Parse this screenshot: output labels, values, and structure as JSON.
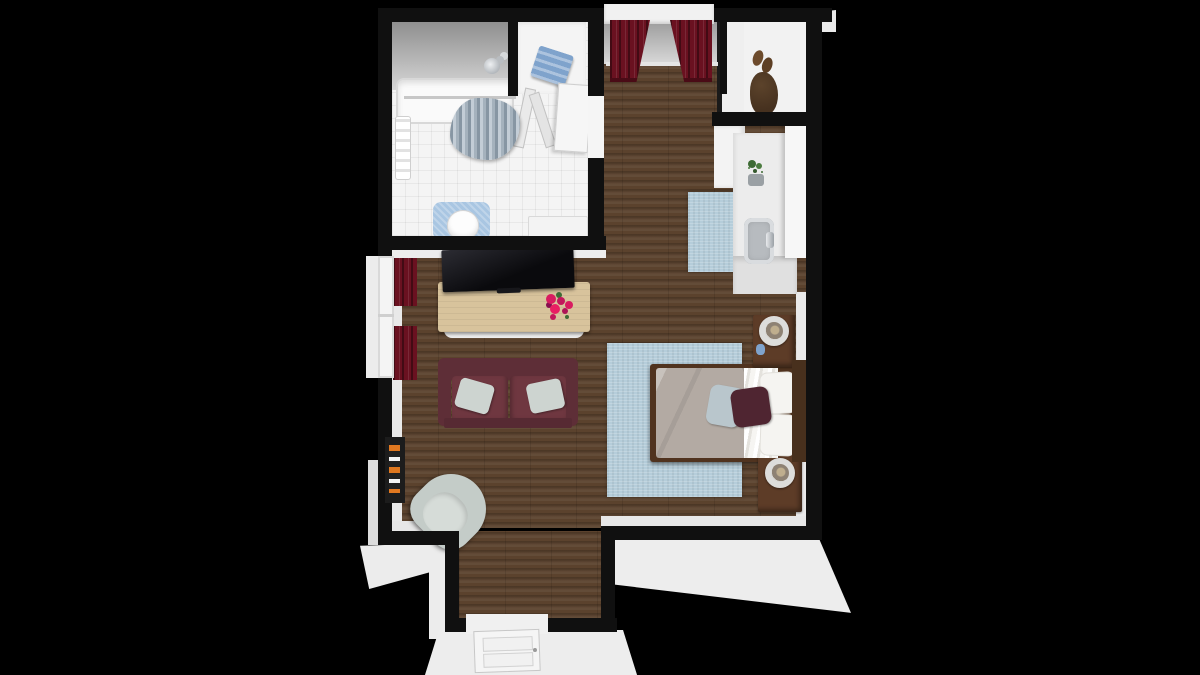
{
  "scene": {
    "type": "3d-floorplan-render",
    "view": "top-down dollhouse",
    "description": "Studio apartment 3D floor plan on black background"
  },
  "colors": {
    "background": "#000000",
    "wall": "#101010",
    "wall_face": "#ededed",
    "wood": "#5b422d",
    "tile": "#f4f4f4",
    "rug": "#b5cdda",
    "curtain": "#6a1120",
    "sofa": "#6f3740",
    "sofa_dark": "#5e2e37",
    "duvet": "#b3aaa3",
    "pillow_maroon": "#4f2531",
    "pillow_blue": "#b9c6cc",
    "dark_wood": "#5d3c27",
    "console_wood": "#d8c39c",
    "armchair": "#cdd4d0",
    "towel_blue": "#7fa3cc",
    "flower": "#d81b60",
    "plant": "#3e6b35",
    "tv": "#0b0b0e",
    "chrome": "#c9ccd0"
  },
  "rooms": [
    {
      "name": "Bathroom"
    },
    {
      "name": "Linen closet"
    },
    {
      "name": "Wardrobe closet"
    },
    {
      "name": "Kitchenette"
    },
    {
      "name": "Living area"
    },
    {
      "name": "Sleeping area"
    },
    {
      "name": "Entry"
    }
  ],
  "furniture": [
    {
      "name": "Bathtub with shower"
    },
    {
      "name": "Shower curtain"
    },
    {
      "name": "Shower head"
    },
    {
      "name": "Towel rack"
    },
    {
      "name": "Toilet"
    },
    {
      "name": "Toilet contour mat"
    },
    {
      "name": "Bathroom vanity"
    },
    {
      "name": "Towel shelf"
    },
    {
      "name": "Bifold closet door"
    },
    {
      "name": "Bathroom door"
    },
    {
      "name": "Pair of shoes"
    },
    {
      "name": "Hanging coat"
    },
    {
      "name": "Kitchen counter"
    },
    {
      "name": "Kitchen sink"
    },
    {
      "name": "Potted plant"
    },
    {
      "name": "Upper cabinet"
    },
    {
      "name": "Base cabinet"
    },
    {
      "name": "Tall cabinet"
    },
    {
      "name": "Kitchen rug"
    },
    {
      "name": "Area rug"
    },
    {
      "name": "Double bed"
    },
    {
      "name": "Duvet"
    },
    {
      "name": "Bed pillows"
    },
    {
      "name": "Accent pillow blue"
    },
    {
      "name": "Accent pillow maroon"
    },
    {
      "name": "Nightstand (head of bed)"
    },
    {
      "name": "Table lamp"
    },
    {
      "name": "Nightstand (foot of bed)"
    },
    {
      "name": "Table lamp"
    },
    {
      "name": "Flat-screen TV"
    },
    {
      "name": "TV console"
    },
    {
      "name": "Flower bouquet"
    },
    {
      "name": "Loveseat sofa"
    },
    {
      "name": "Sofa pillow"
    },
    {
      "name": "Sofa pillow"
    },
    {
      "name": "Armchair"
    },
    {
      "name": "Window curtains (left wall)"
    },
    {
      "name": "Window curtains (bedroom)"
    },
    {
      "name": "Wall artwork"
    },
    {
      "name": "Entry door"
    },
    {
      "name": "Headboard"
    }
  ]
}
